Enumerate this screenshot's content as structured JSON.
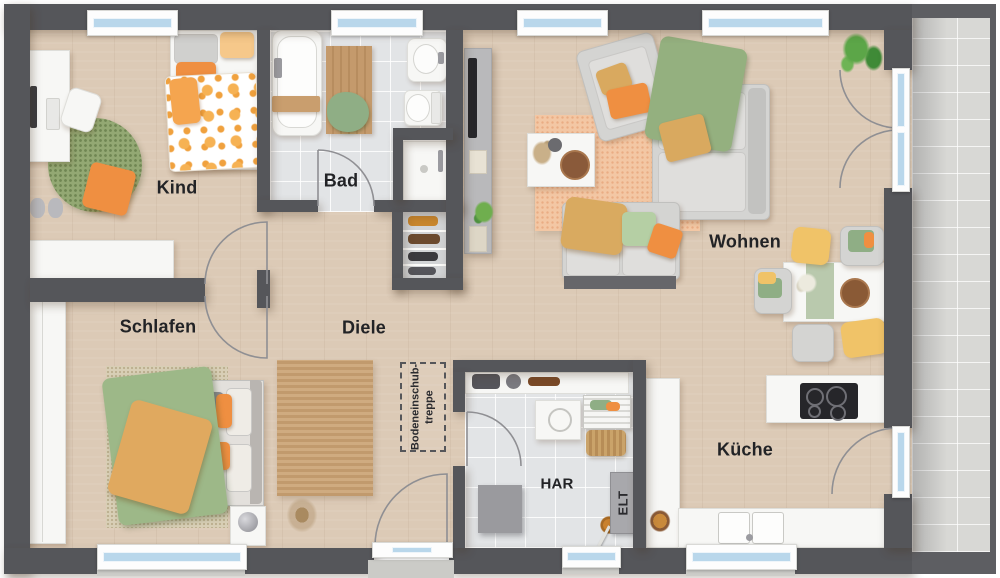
{
  "rooms": {
    "kind": {
      "label": "Kind"
    },
    "bad": {
      "label": "Bad"
    },
    "wohnen": {
      "label": "Wohnen"
    },
    "schlafen": {
      "label": "Schlafen"
    },
    "diele": {
      "label": "Diele"
    },
    "kueche": {
      "label": "Küche"
    },
    "har": {
      "label": "HAR"
    },
    "elt": {
      "label": "ELT"
    },
    "attic_stairs": {
      "label_line1": "Bodeneinschub-",
      "label_line2": "treppe"
    }
  },
  "colors": {
    "wall": "#55565a",
    "floor_wood": "#dccab6",
    "bath_tile": "#e2e4e6",
    "terrace_tile": "#d8d8d5",
    "accent_orange": "#ef8f41",
    "accent_green": "#9db888",
    "accent_yellow": "#f0c368",
    "rug_peach": "#f3c7a4",
    "window_glass": "#b9d7eb"
  }
}
